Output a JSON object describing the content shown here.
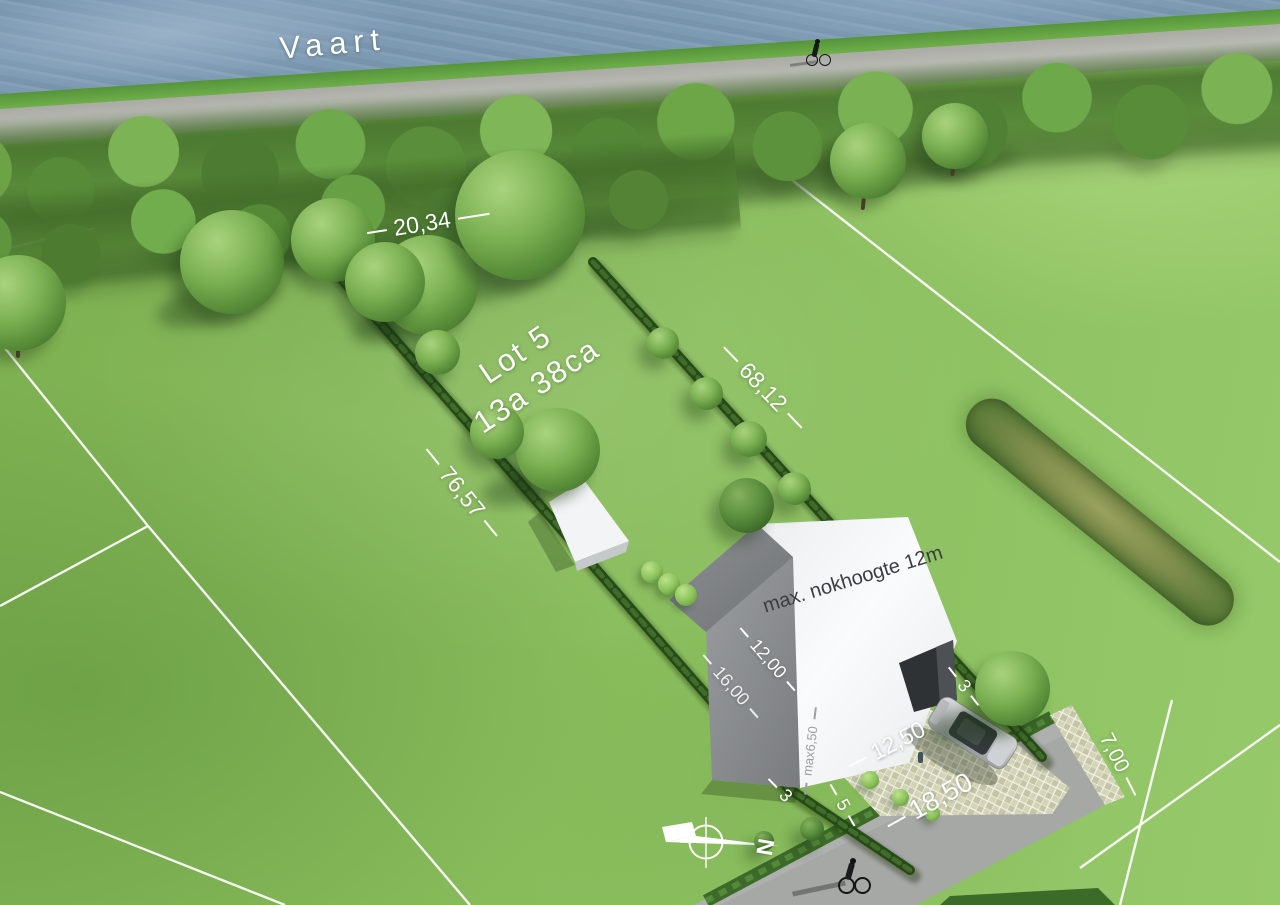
{
  "labels": {
    "water": "Vaart",
    "lot_name": "Lot 5",
    "lot_area": "13a 38ca",
    "dim_top": "20,34",
    "dim_right": "68,12",
    "dim_left": "76,57",
    "ridge_note": "max. nokhoogte 12m",
    "dim_house_upper": "12,00",
    "dim_house_lower": "16,00",
    "dim_eave": "max6,50",
    "dim_driveway": "12,50",
    "dim_frontage": "18,50",
    "dim_road_end": "7,00",
    "setback_left": "3",
    "setback_front": "5",
    "setback_right": "3",
    "north": "N"
  },
  "colors": {
    "water": "#7d9ab3",
    "grass": "#84b858",
    "hedge": "#264a18",
    "road": "#a6a8a5",
    "house_white": "#f5f6f7",
    "house_gray": "#8b8e91",
    "label": "#ffffff"
  }
}
